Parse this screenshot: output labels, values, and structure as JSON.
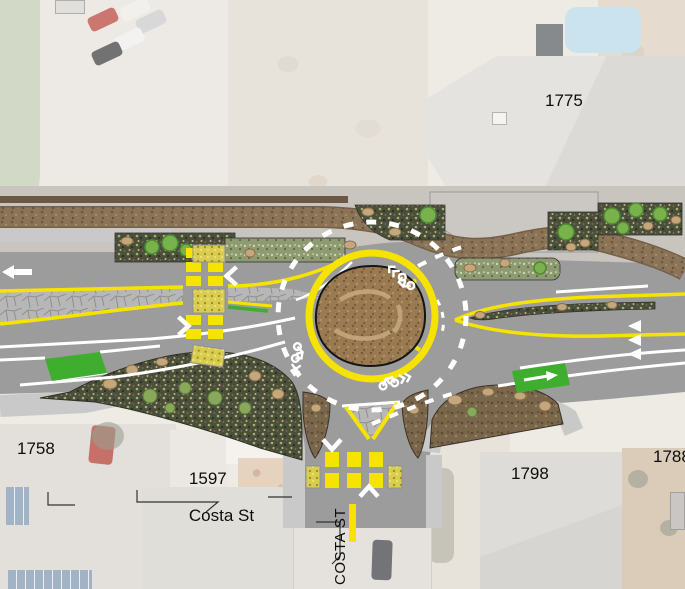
{
  "labels": {
    "parcel_ne": "1775",
    "parcel_nw": "1758",
    "parcel_sw_number": "1597",
    "parcel_sw_street": "Costa St",
    "parcel_se": "1798",
    "parcel_far_se": "1788",
    "street_vertical": "COSTA ST"
  },
  "colors": {
    "road": "#9c9c9c",
    "sidewalk": "#c9c9c9",
    "marking_yellow": "#f6e400",
    "marking_white": "#ffffff",
    "bike_lane_green": "#3fae2e",
    "landscape_dark": "#4a4e3b",
    "mulch_brown": "#8b7357",
    "center_island_brown": "#9a7b51",
    "aerial_faded": "#e8e3dc"
  },
  "icons": {
    "sharrow_marking": "bike-sharrow",
    "lane_chevron": "chevron-arrow",
    "yield_marking": "yield-triangles",
    "crosswalk_style": "yellow-ladder-crosswalk",
    "ramp_style": "truncated-dome-yellow"
  }
}
